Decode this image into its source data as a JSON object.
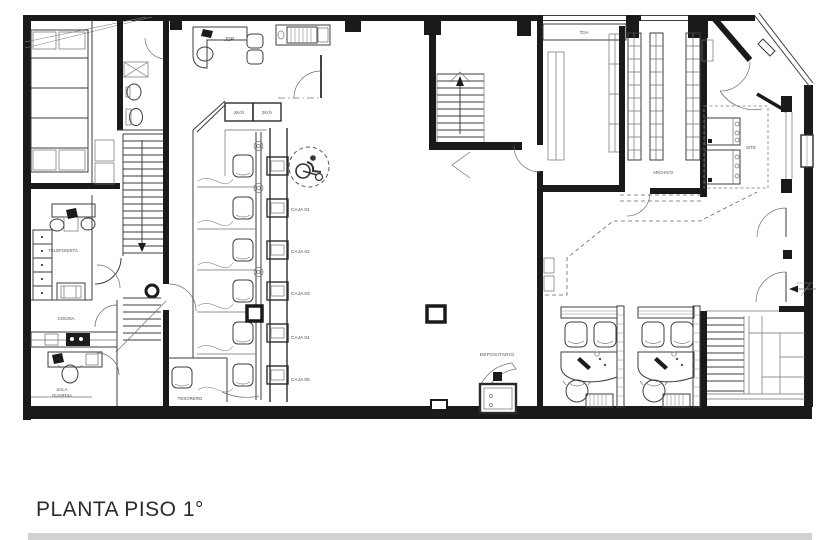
{
  "title": "PLANTA PISO 1°",
  "rooms": {
    "jop": "JOP",
    "kch_left": "2Kch",
    "kch_right": "2Kch",
    "tda": "TDA",
    "archivo": "ARCHIVO",
    "site": "SITE",
    "telefonista": "TELEFONISTA",
    "cocina": "COCINA",
    "sala_guardia": [
      "SALA",
      "GUARDIA"
    ],
    "tesorero": "TESORERO",
    "depositario": "DEPOSITARIO"
  },
  "tellers": [
    {
      "label": "CAJA 01"
    },
    {
      "label": "CAJA 02"
    },
    {
      "label": "CAJA 03"
    },
    {
      "label": "CAJA 04"
    },
    {
      "label": "CAJA 05"
    }
  ],
  "symbols": {
    "wheelchair": "wheelchair-icon",
    "stairs_up": "arrow-up-icon",
    "exit": "arrow-left-icon"
  },
  "colors": {
    "wall": "#1a1a1a",
    "drawing_line": "#3d3d3d",
    "furniture_line": "#707070",
    "label_text": "#4f4f4f",
    "title_text": "#2b2b2b",
    "background": "#ffffff",
    "bottom_strip": "#d2d2d2"
  }
}
